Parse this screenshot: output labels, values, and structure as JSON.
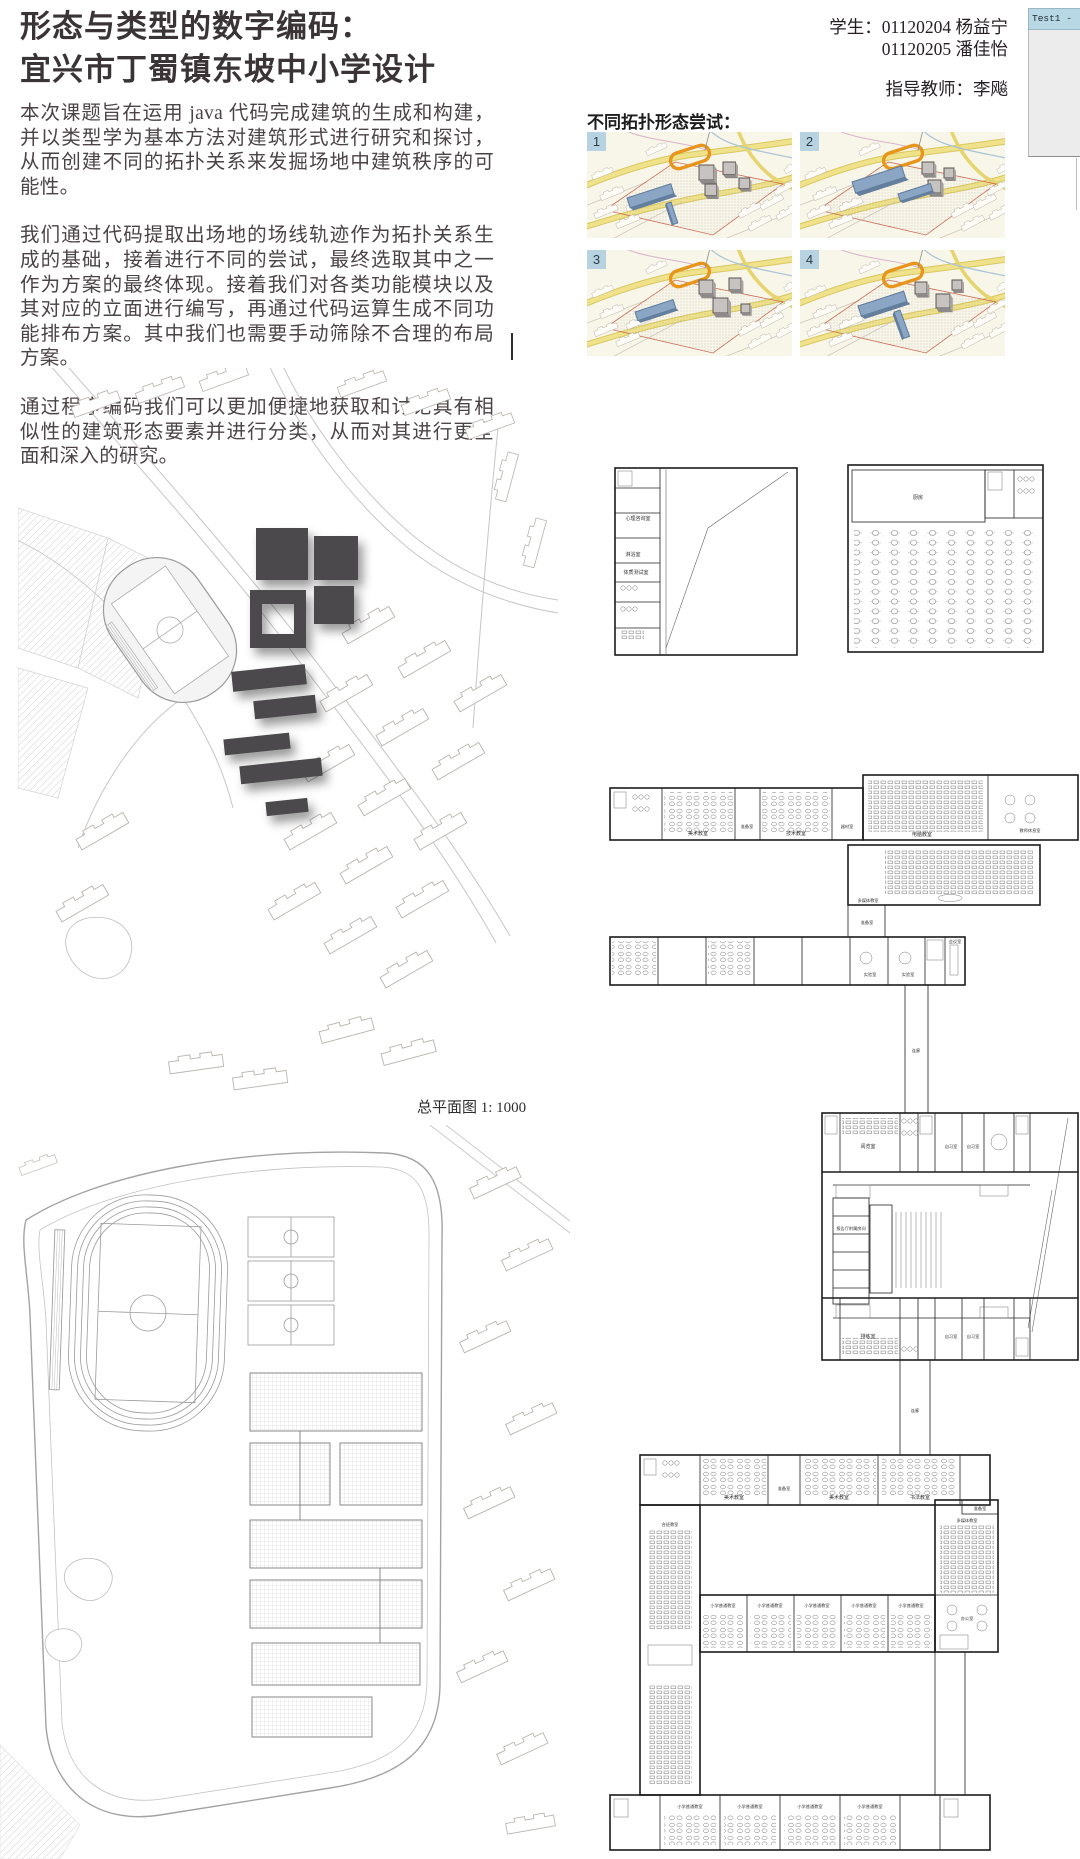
{
  "header": {
    "title_line1": "形态与类型的数字编码：",
    "title_line2": "宜兴市丁蜀镇东坡中小学设计",
    "student_line1": "学生：01120204 杨益宁",
    "student_line2": "01120205 潘佳怡",
    "advisor_line": "指导教师：李飚"
  },
  "test_window": {
    "title": "Test1 -"
  },
  "intro": {
    "p1": "本次课题旨在运用 java 代码完成建筑的生成和构建，并以类型学为基本方法对建筑形式进行研究和探讨，从而创建不同的拓扑关系来发掘场地中建筑秩序的可能性。",
    "p2": "我们通过代码提取出场地的场线轨迹作为拓扑关系生成的基础，接着进行不同的尝试，最终选取其中之一作为方案的最终体现。接着我们对各类功能模块以及其对应的立面进行编写，再通过代码运算生成不同功能排布方案。其中我们也需要手动筛除不合理的布局方案。",
    "p3": "通过程序编码我们可以更加便捷地获取和讨论具有相似性的建筑形态要素并进行分类，从而对其进行更全面和深入的研究。"
  },
  "topology": {
    "heading": "不同拓扑形态尝试：",
    "items": [
      {
        "num": "1"
      },
      {
        "num": "2"
      },
      {
        "num": "3"
      },
      {
        "num": "4"
      }
    ]
  },
  "site_plan1": {
    "caption": "总平面图  1: 1000"
  },
  "plans": {
    "fitness": {
      "room1": "心理咨询室",
      "room2": "淋浴室",
      "room3": "体质测试室"
    },
    "canteen": {
      "kitchen": "厨房"
    },
    "special": {
      "art1": "美术教室",
      "prep1": "准备室",
      "art2": "技术教室",
      "equip": "器材室",
      "computer": "电脑教室",
      "teacher": "教师休息室",
      "media": "多媒体教室",
      "prep2": "准备室",
      "lab1": "实验室",
      "lab2": "实验室",
      "meeting": "会议室",
      "corridor": "连廊"
    },
    "library": {
      "reading": "阅览室",
      "study1": "自习室",
      "study2": "自习室",
      "aux": "报告厅附属房间",
      "rehearsal": "排练室",
      "study3": "自习室",
      "study4": "自习室",
      "corridor": "连廊"
    },
    "classrooms": {
      "art1": "美术教室",
      "prep": "准备室",
      "art2": "美术教室",
      "calligraphy": "书法教室",
      "combined": "合班教室",
      "regular1": "小学普通教室",
      "regular2": "小学普通教室",
      "regular3": "小学普通教室",
      "regular4": "小学普通教室",
      "regular5": "小学普通教室",
      "media": "多媒体教室",
      "office": "办公室",
      "regular6": "小学普通教室",
      "regular7": "小学普通教室",
      "regular8": "小学普通教室",
      "regular9": "小学普通教室"
    }
  },
  "colors": {
    "track_orange": "#e8951c",
    "building_blue": "#8ba6c5",
    "badge_blue": "#b7d3e1",
    "titlebar_blue": "#b9d8e5"
  }
}
